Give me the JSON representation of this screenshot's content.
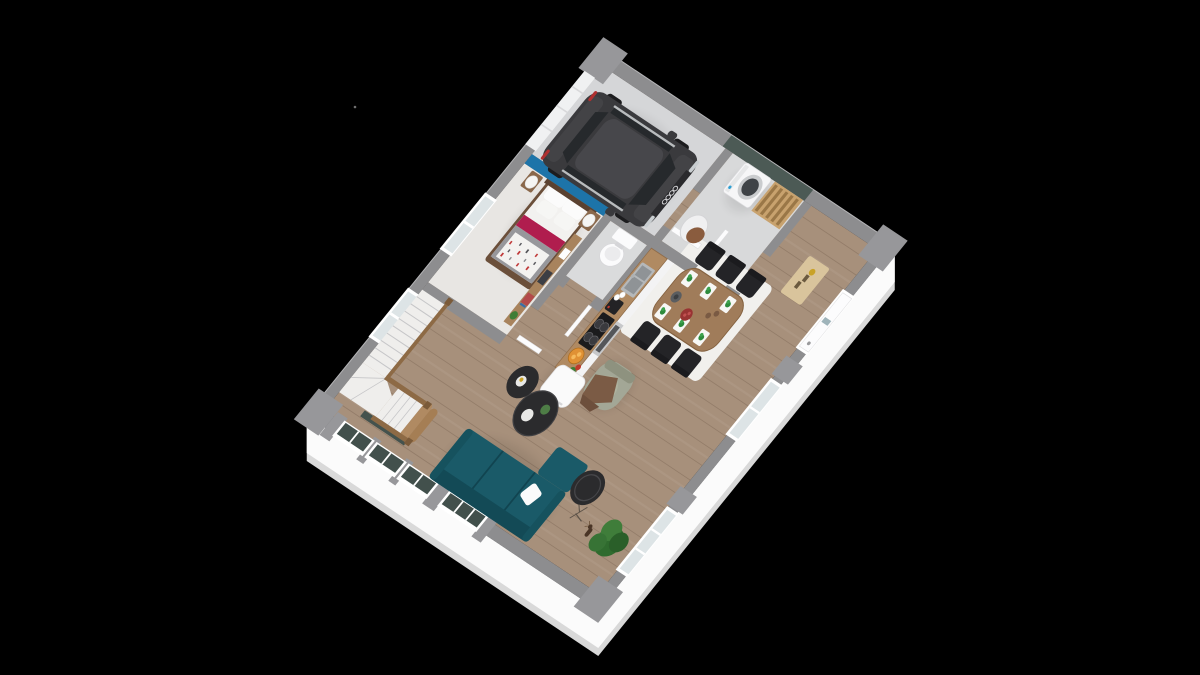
{
  "scene": {
    "kind": "isometric-3d-floorplan-render",
    "background": "#000000",
    "floor_level": "ground-floor",
    "rooms": [
      {
        "name": "garage",
        "objects": [
          "suv-car",
          "garage-door"
        ]
      },
      {
        "name": "bedroom",
        "objects": [
          "double-bed",
          "nightstand-lamps",
          "foot-shelf",
          "blue-accent-wall"
        ]
      },
      {
        "name": "stairwell",
        "objects": [
          "quarter-turn-staircase",
          "wood-balustrade"
        ]
      },
      {
        "name": "wc",
        "objects": [
          "toilet"
        ]
      },
      {
        "name": "kitchen",
        "objects": [
          "counter",
          "hob",
          "oven",
          "sink",
          "coffee-machine",
          "fruit-bowl",
          "fridge"
        ]
      },
      {
        "name": "dining-area",
        "objects": [
          "wood-table",
          "six-black-chairs",
          "white-rug",
          "placemats",
          "carafe"
        ]
      },
      {
        "name": "living-room",
        "objects": [
          "teal-sofa",
          "coffee-tables",
          "armchair",
          "side-table",
          "plant",
          "deer-figurine"
        ]
      },
      {
        "name": "laundry-room",
        "objects": [
          "washing-machine",
          "drying-rack",
          "laundry-basket",
          "green-wall"
        ]
      },
      {
        "name": "entry",
        "objects": [
          "front-door",
          "doormat"
        ]
      }
    ]
  },
  "palette": {
    "bg": "#000000",
    "wallTop": "#8d8d8f",
    "wallBlock": "#97979a",
    "skirtWhite": "#fbfbfb",
    "skirtGrey": "#d9d9d9",
    "edgeLight": "#b5b5b7",
    "floorWood": "#a7907b",
    "floorBedroom": "#e8e6e3",
    "floorGarage": "#d5d6d8",
    "floorLaundry": "#d8d9da",
    "floorWc": "#dadbdc",
    "accentBlue": "#1d74a9",
    "laundryWall": "#4c5a55",
    "stairAccent": "#44524d",
    "windowPanel": "#42504c",
    "frameWhite": "#ffffff",
    "glassLight": "#dde4e6",
    "garageDoor": "#f0f1f2",
    "carBody": "#3a3a3d",
    "carShade": "#434346",
    "carRoof": "#47474b",
    "carGlass": "#26292c",
    "carWheel": "#1c1c1e",
    "carRing": "#cfcfd2",
    "tailRed": "#b03030",
    "headlight": "#c8cdd0",
    "sofa": "#1a5a68",
    "sofaDark": "#134a56",
    "sofaSeam": "#114450",
    "pillowWhite": "#fbfbfb",
    "armchair": "#a3a796",
    "armchairBack": "#8e927f",
    "throwBrown": "#7b5b45",
    "tableBlack": "#2b2b2d",
    "rug": "#f1f0ed",
    "diningTable": "#a07c5a",
    "chairBlack": "#242427",
    "placemat": "#f7f7f5",
    "sprigGreen": "#2e8b3d",
    "counterTop": "#b08a62",
    "cabinetWhite": "#f3f3f4",
    "hobBlack": "#1b1b1d",
    "sinkSteel": "#b5b8ba",
    "ovenSteel": "#c7c8ca",
    "fridgeWhite": "#fafafa",
    "bedFrame": "#6b4f3a",
    "headboard": "#5a4130",
    "duvetWhite": "#f2f1ef",
    "duvetGrey": "#97979b",
    "runnerMagenta": "#b01d4e",
    "patternRed": "#c03a3a",
    "nightstand": "#8a684b",
    "shelfWood": "#a8835d",
    "treadWhite": "#efeeec",
    "treadLine": "#c6c6c8",
    "railWood": "#8d6a45",
    "newelWood": "#7a5a39",
    "stepWood": "#b08a62",
    "washerWhite": "#f6f6f7",
    "washerDoor": "#3f4347",
    "washerBlue": "#2e9fd4",
    "rackWood": "#c8a26e",
    "slatWood": "#9a7747",
    "basketWhite": "#f0f0f1",
    "towelBrown": "#8a5c3e",
    "toiletWhite": "#fbfbfc",
    "doormat": "#d9c49c",
    "plantGreen": "#2f6b2e",
    "plantLight": "#3f7d3a",
    "deerBrown": "#4a3526",
    "doorLeaf": "#fcfcfd",
    "plankLine": "rgba(60,40,25,0.18)"
  }
}
